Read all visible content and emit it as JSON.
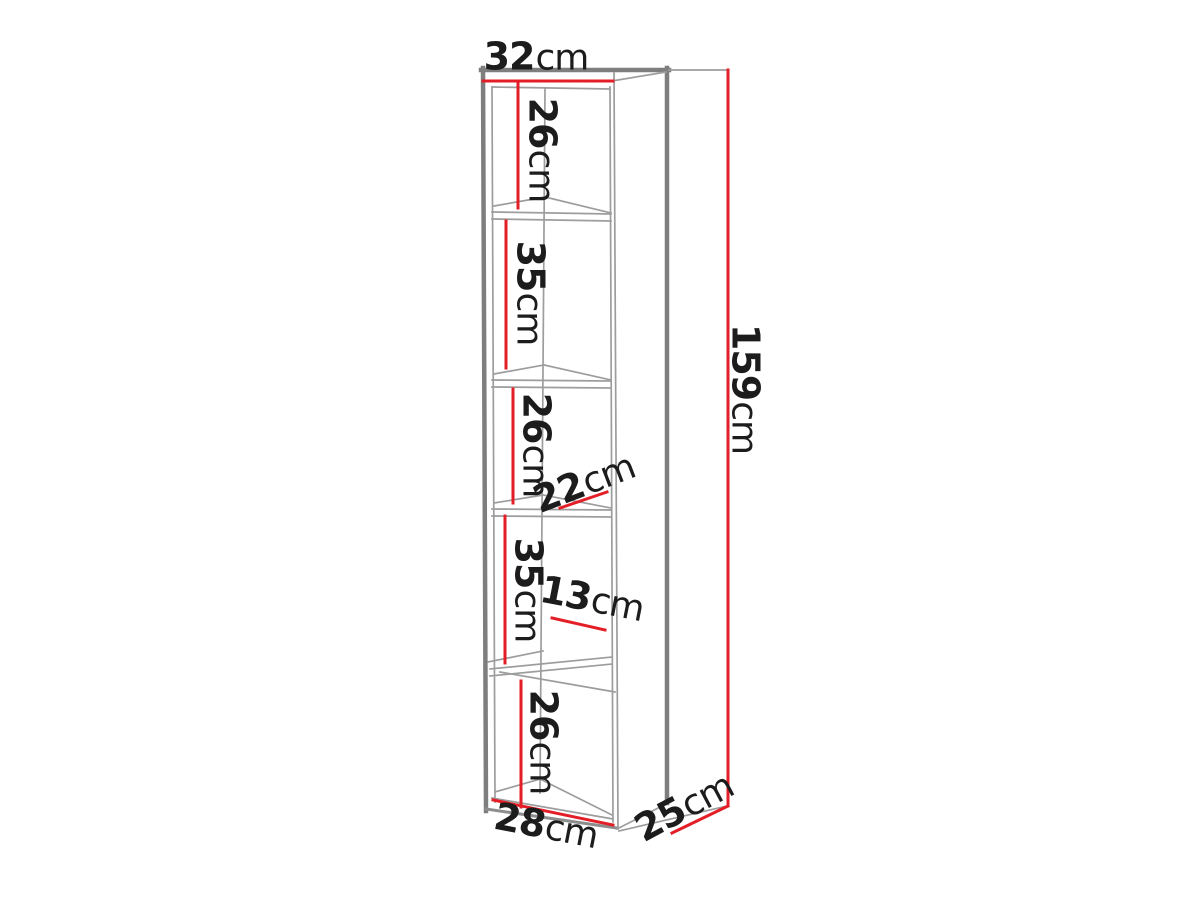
{
  "page": {
    "background": "#ffffff"
  },
  "colors": {
    "dimension_red": "#e41e26",
    "outline_dark": "#7e7e7e",
    "outline_mid": "#8d8d8d",
    "outline_light": "#9d9d9d",
    "label_text": "#1c1c1c"
  },
  "diagram": {
    "type": "furniture-dimension-diagram",
    "subject": "tall narrow open shelving unit with five compartments, drawn in perspective",
    "dimensions": [
      {
        "id": "top-outer-width",
        "value": "32",
        "unit": "cm"
      },
      {
        "id": "compartment-1-height",
        "value": "26",
        "unit": "cm"
      },
      {
        "id": "compartment-2-height",
        "value": "35",
        "unit": "cm"
      },
      {
        "id": "compartment-3-height",
        "value": "26",
        "unit": "cm"
      },
      {
        "id": "shelf-depth",
        "value": "22",
        "unit": "cm"
      },
      {
        "id": "compartment-4-height",
        "value": "35",
        "unit": "cm"
      },
      {
        "id": "inner-section-width",
        "value": "13",
        "unit": "cm"
      },
      {
        "id": "compartment-5-height",
        "value": "26",
        "unit": "cm"
      },
      {
        "id": "bottom-inner-width",
        "value": "28",
        "unit": "cm"
      },
      {
        "id": "side-depth",
        "value": "25",
        "unit": "cm"
      },
      {
        "id": "total-height",
        "value": "159",
        "unit": "cm"
      }
    ]
  }
}
